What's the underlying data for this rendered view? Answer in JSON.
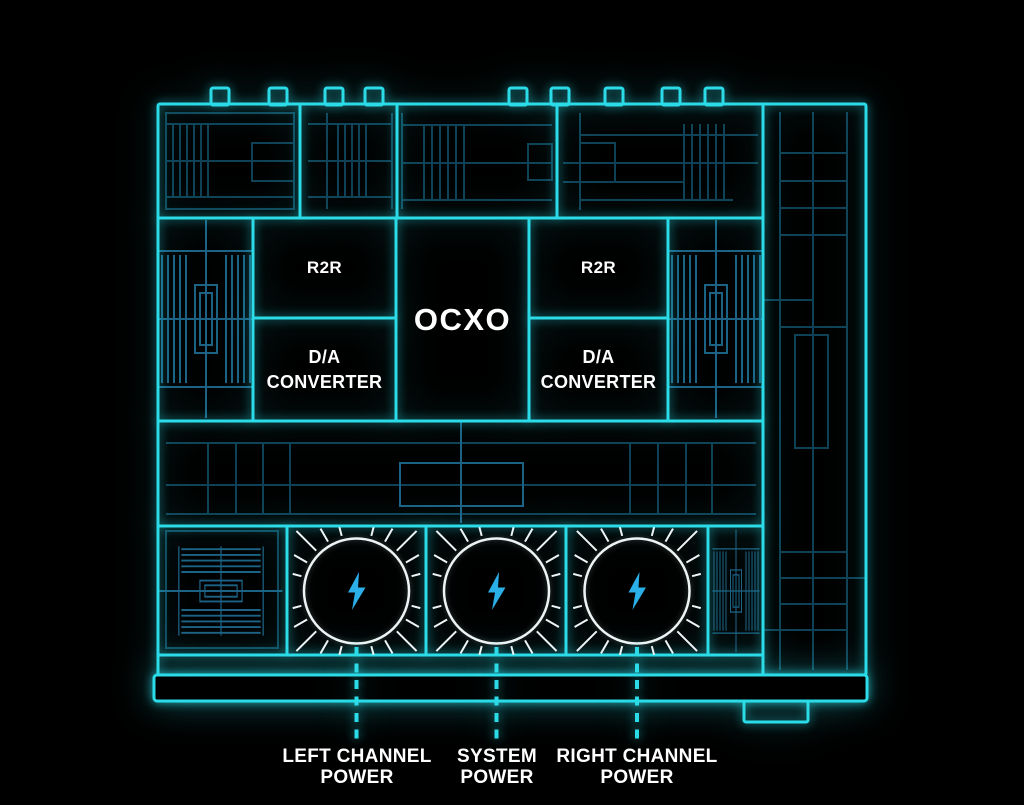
{
  "diagram": {
    "blocks": {
      "r2r_left": "R2R",
      "r2r_right": "R2R",
      "ocxo": "OCXO",
      "da_left": {
        "line1": "D/A",
        "line2": "CONVERTER"
      },
      "da_right": {
        "line1": "D/A",
        "line2": "CONVERTER"
      }
    },
    "power_callouts": [
      {
        "line1": "LEFT CHANNEL",
        "line2": "POWER"
      },
      {
        "line1": "SYSTEM",
        "line2": "POWER"
      },
      {
        "line1": "RIGHT CHANNEL",
        "line2": "POWER"
      }
    ],
    "icons": {
      "power": "lightning-bolt-icon"
    },
    "colors": {
      "background": "#000000",
      "outline_cyan": "#2bdce8",
      "detail_blue": "#0f4156",
      "detail_blue_bright": "#1c6285",
      "bolt_blue": "#2aafe8",
      "circle_white": "#eef4f5",
      "label_white": "#ffffff"
    }
  }
}
